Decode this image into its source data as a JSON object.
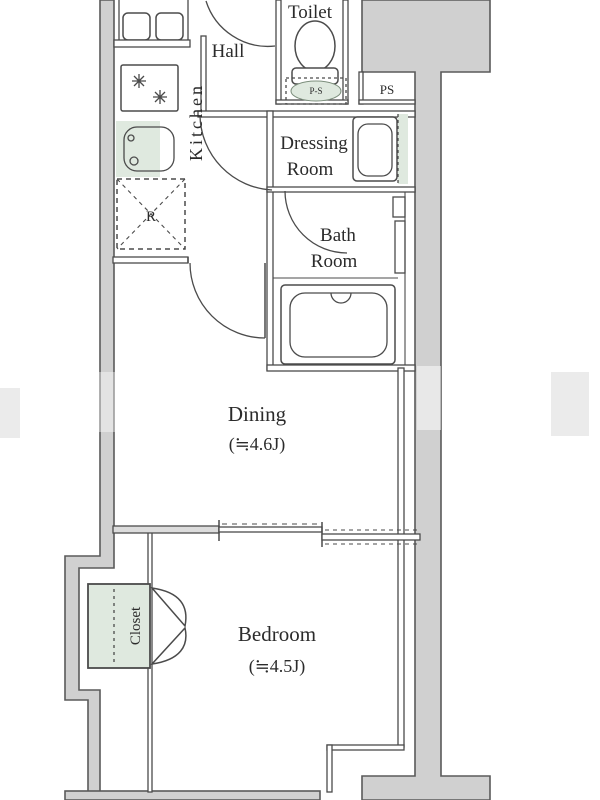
{
  "floorplan": {
    "rooms": {
      "toilet": "Toilet",
      "hall": "Hall",
      "kitchen": "Kitchen",
      "ps": "PS",
      "dressing_line1": "Dressing",
      "dressing_line2": "Room",
      "bath_line1": "Bath",
      "bath_line2": "Room",
      "dining": "Dining",
      "dining_size": "(≒4.6J)",
      "bedroom": "Bedroom",
      "bedroom_size": "(≒4.5J)",
      "closet": "Closet"
    },
    "fixtures": {
      "refrigerator": "R",
      "toilet_tank": "P-S"
    },
    "colors": {
      "wall_fill": "#d0d0d0",
      "wall_stroke": "#5a5a5a",
      "line": "#4b4b4b",
      "fixture_green": "#dfe9df",
      "text": "#2b2b2b"
    }
  }
}
